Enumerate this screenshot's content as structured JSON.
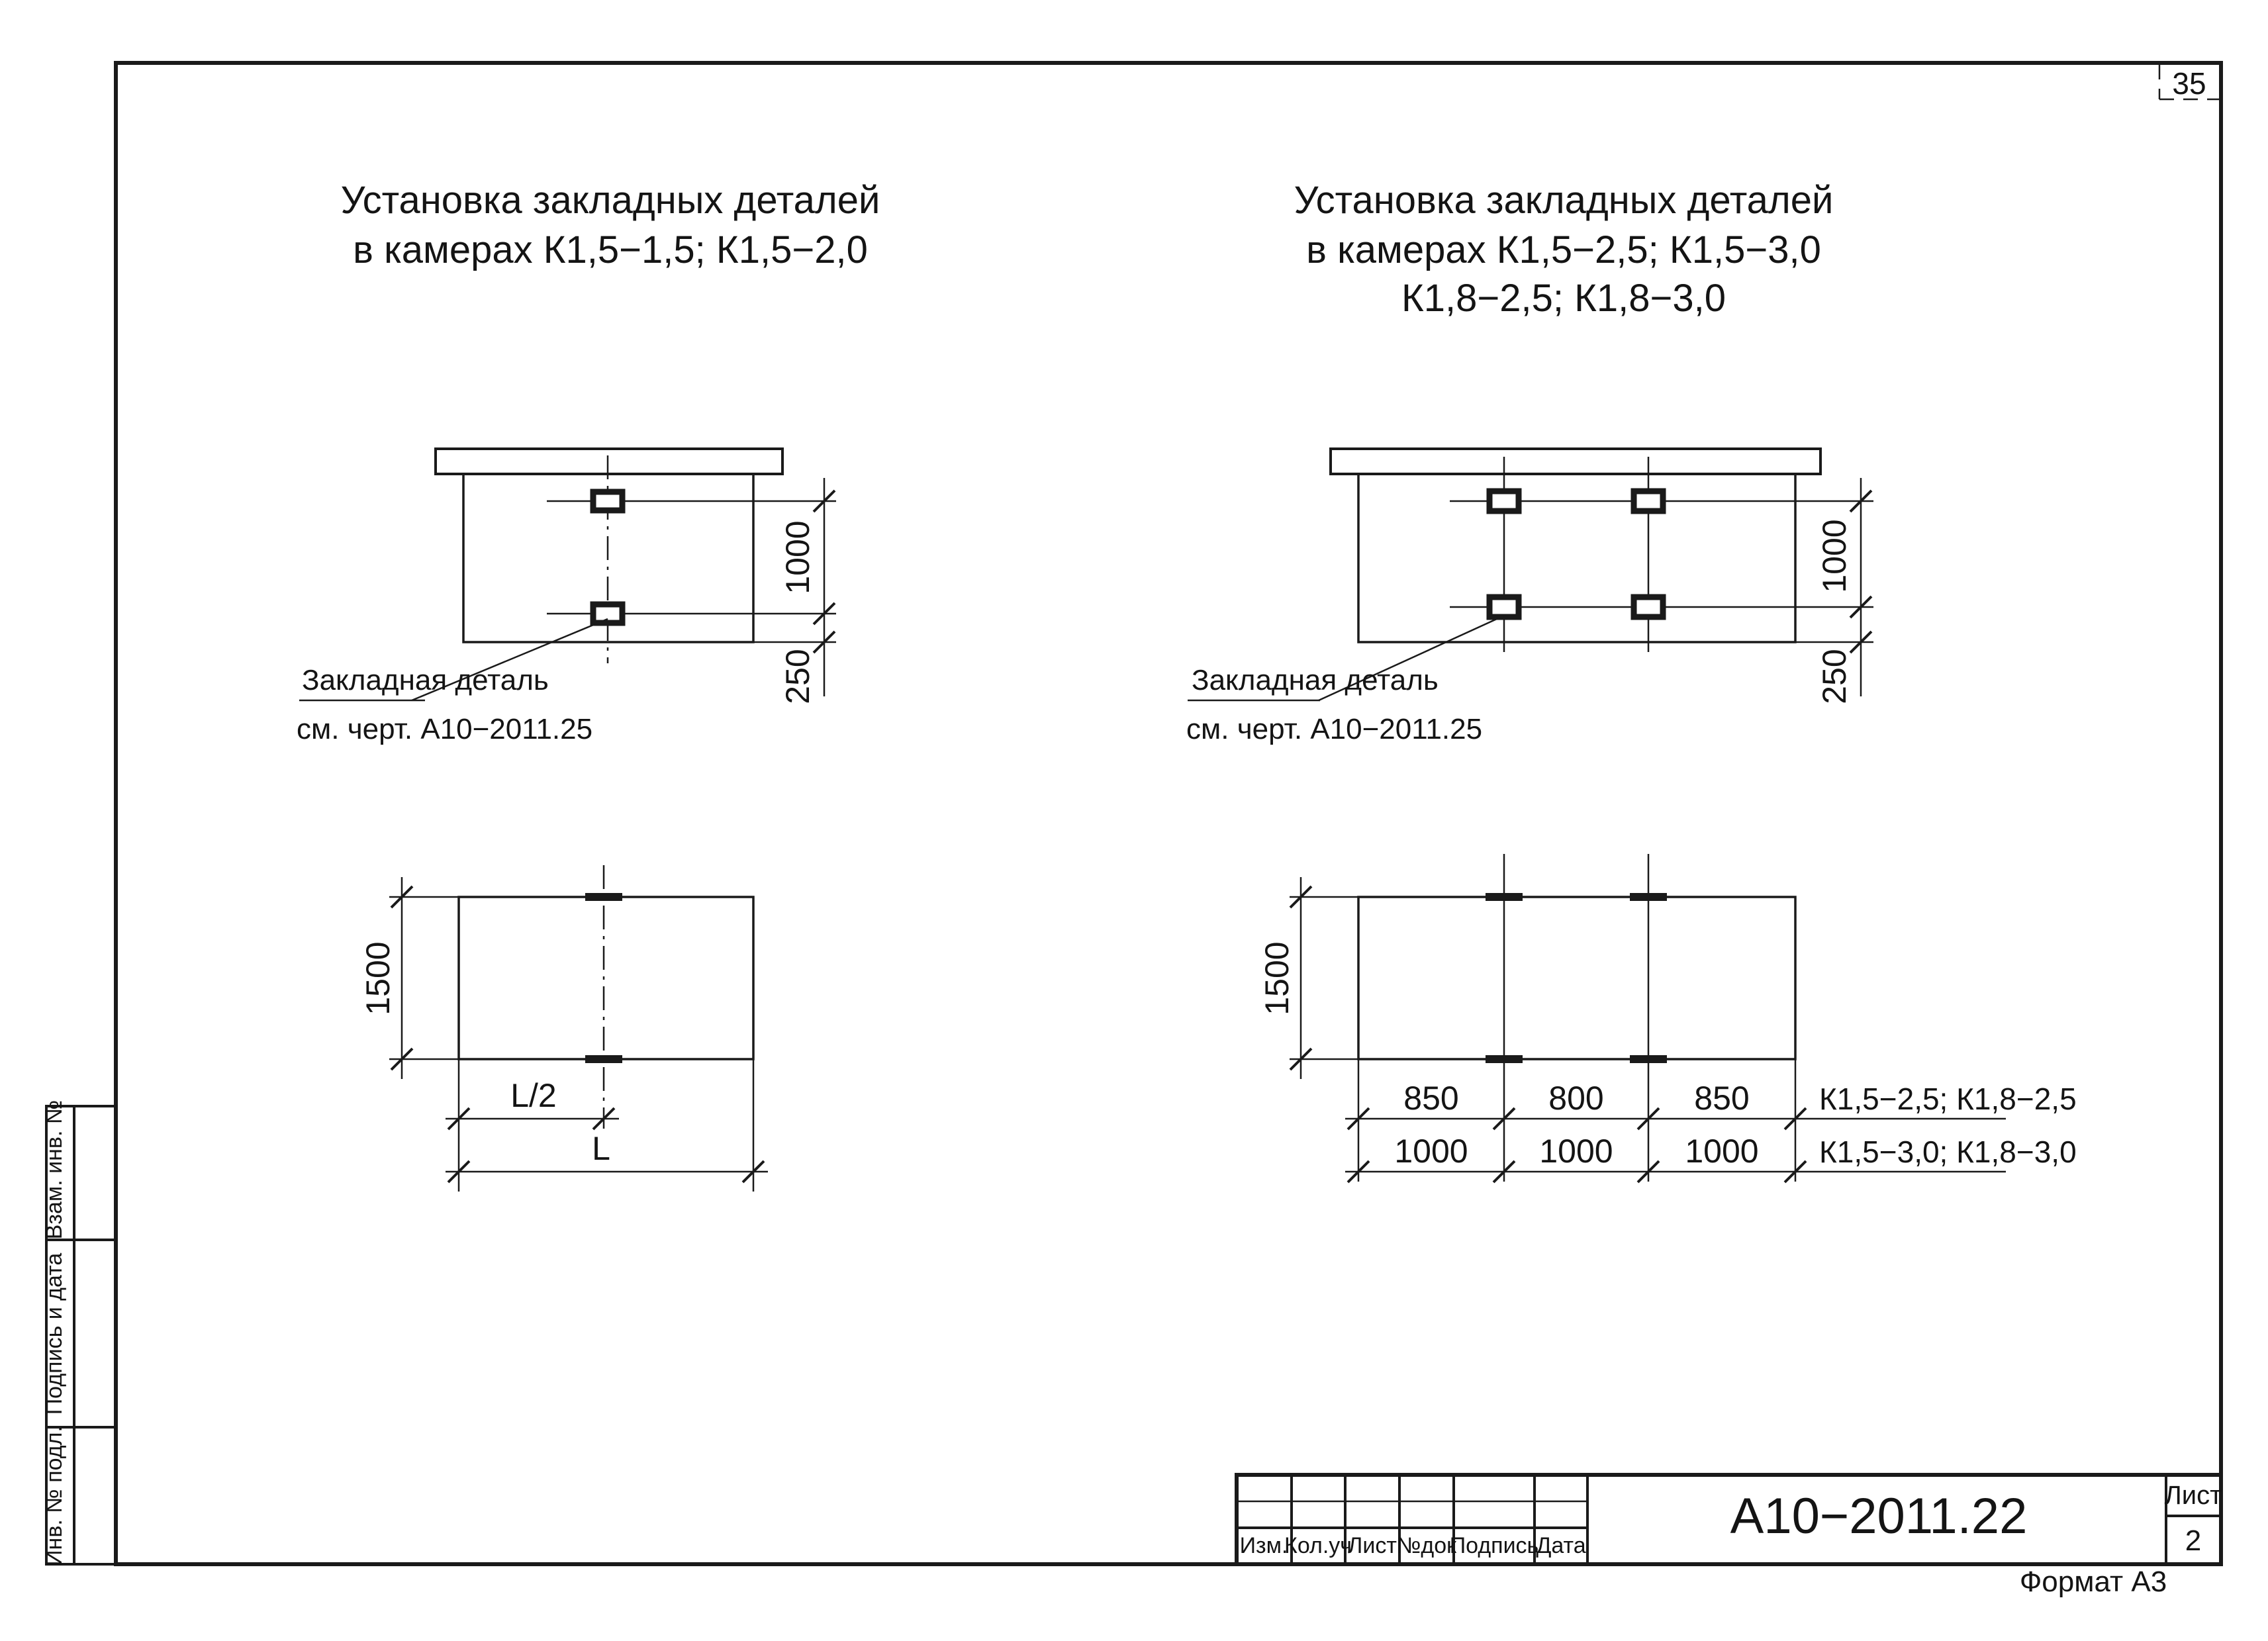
{
  "sheet": {
    "number": "35",
    "format": "Формат А3",
    "ink": "#1a1a1a",
    "background": "#ffffff"
  },
  "titles": {
    "left": {
      "line1": "Установка закладных деталей",
      "line2": "в камерах К1,5−1,5;  К1,5−2,0"
    },
    "right": {
      "line1": "Установка закладных деталей",
      "line2": "в камерах К1,5−2,5;  К1,5−3,0",
      "line3": "К1,8−2,5;  К1,8−3,0"
    }
  },
  "section_left": {
    "dim_height": "1000",
    "dim_offset": "250",
    "callout": {
      "line1": "Закладная деталь",
      "line2": "см. черт. А10−2011.25"
    }
  },
  "section_right": {
    "dim_height": "1000",
    "dim_offset": "250",
    "callout": {
      "line1": "Закладная деталь",
      "line2": "см. черт. А10−2011.25"
    }
  },
  "plan_left": {
    "dim_side": "1500",
    "dim_half": "L/2",
    "dim_full": "L"
  },
  "plan_right": {
    "dim_side": "1500",
    "row1": {
      "d1": "850",
      "d2": "800",
      "d3": "850",
      "label": "К1,5−2,5;  К1,8−2,5"
    },
    "row2": {
      "d1": "1000",
      "d2": "1000",
      "d3": "1000",
      "label": "К1,5−3,0;  К1,8−3,0"
    }
  },
  "title_block": {
    "doc_number": "А10−2011.22",
    "sheet_label": "Лист",
    "sheet_value": "2",
    "col1": "Изм.",
    "col2": "Кол.уч",
    "col3": "Лист",
    "col4": "№док",
    "col5": "Подпись",
    "col6": "Дата"
  },
  "side_stamp": {
    "box1": "Взам. инв. №",
    "box2": "Подпись и дата",
    "box3": "Инв. № подл."
  }
}
